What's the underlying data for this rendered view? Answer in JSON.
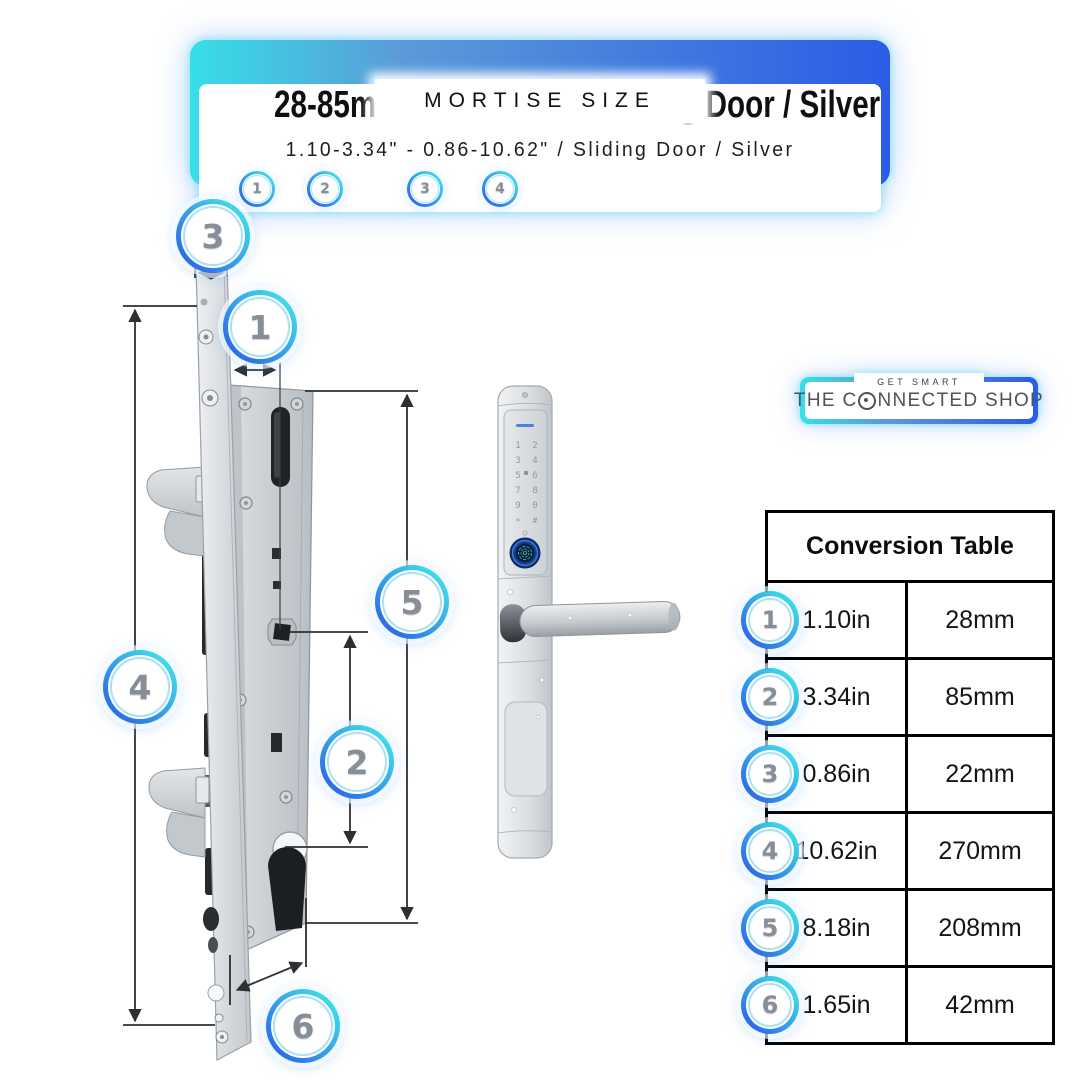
{
  "header": {
    "eyebrow": "MORTISE SIZE",
    "title": "28-85mm - 22-270mm / Sliding Door / Silver",
    "subtitle": "1.10-3.34\" - 0.86-10.62\" / Sliding Door / Silver",
    "marker_labels": [
      "1",
      "2",
      "3",
      "4"
    ]
  },
  "logo": {
    "tagline": "GET SMART",
    "name_part1": "THE C",
    "name_part2": "NNECTED SHOP",
    "full_name": "THE CONNECTED SHOP"
  },
  "diagram": {
    "callouts": [
      {
        "n": "3"
      },
      {
        "n": "1"
      },
      {
        "n": "4"
      },
      {
        "n": "5"
      },
      {
        "n": "2"
      },
      {
        "n": "6"
      }
    ]
  },
  "handle": {
    "keypad_digits": [
      "1",
      "2",
      "3",
      "4",
      "5",
      "6",
      "7",
      "8",
      "9",
      "0",
      "*",
      "#"
    ]
  },
  "table": {
    "title": "Conversion Table",
    "rows": [
      {
        "num": "1",
        "in": "1.10in",
        "mm": "28mm"
      },
      {
        "num": "2",
        "in": "3.34in",
        "mm": "85mm"
      },
      {
        "num": "3",
        "in": "0.86in",
        "mm": "22mm"
      },
      {
        "num": "4",
        "in": "10.62in",
        "mm": "270mm"
      },
      {
        "num": "5",
        "in": "8.18in",
        "mm": "208mm"
      },
      {
        "num": "6",
        "in": "1.65in",
        "mm": "42mm"
      }
    ]
  },
  "colors": {
    "cyan": "#3BE2E9",
    "blue": "#2B5CE6",
    "steel_blue": "#5B9BD8",
    "callout_gray": "#878E97",
    "table_border": "#000000",
    "fingerprint_green": "#3DB98A"
  }
}
